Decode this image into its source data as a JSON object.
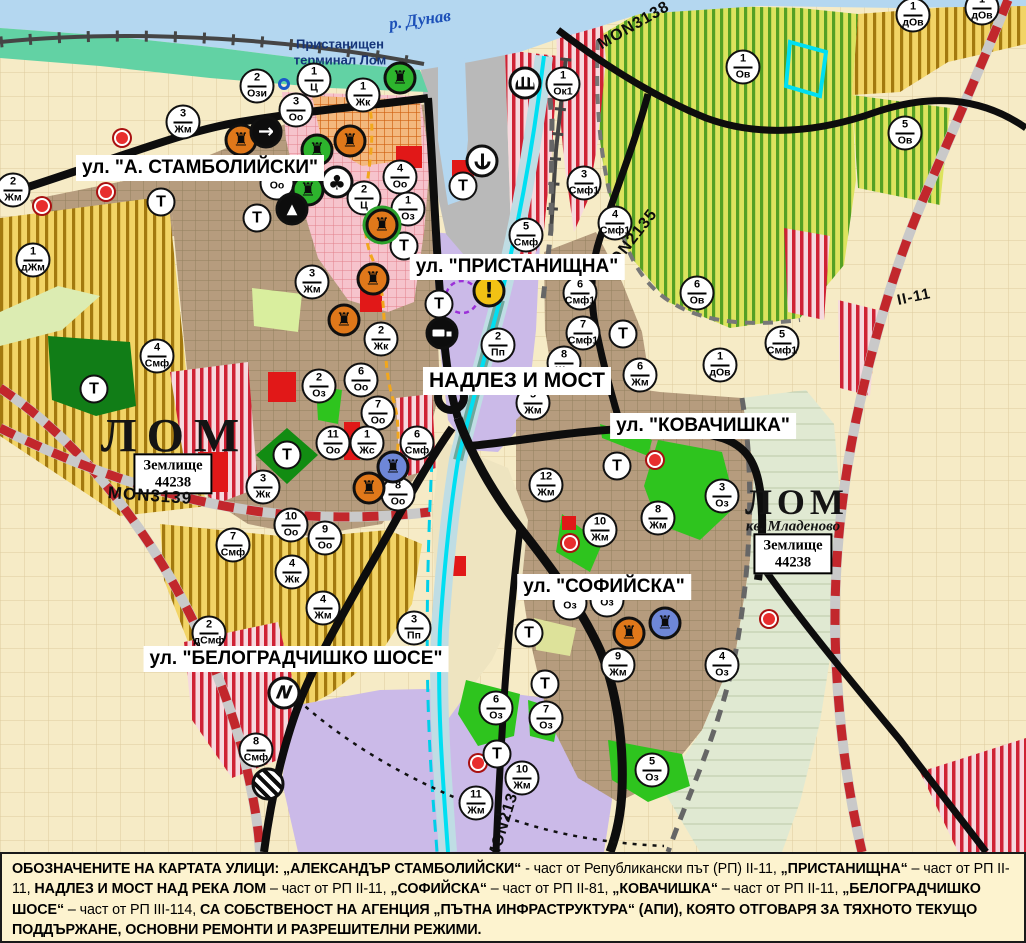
{
  "map": {
    "river_label": "р. Дунав",
    "port_label": "Пристанищен\nтерминал Лом",
    "t_label": "Т",
    "area_labels": {
      "lom_left": "ЛОМ",
      "lom_right": "ЛОМ",
      "lom_right_sub": "кв. Младеново",
      "registry_box_left": "Землище\n44238",
      "registry_box_right": "Землище\n44238"
    },
    "street_labels": [
      {
        "text": "ул. \"А. СТАМБОЛИЙСКИ\"",
        "x": 200,
        "y": 168,
        "fs": 19
      },
      {
        "text": "ул. \"ПРИСТАНИЩНА\"",
        "x": 517,
        "y": 267,
        "fs": 19
      },
      {
        "text": "НАДЛЕЗ И МОСТ",
        "x": 517,
        "y": 381,
        "fs": 21
      },
      {
        "text": "ул. \"КОВАЧИШКА\"",
        "x": 703,
        "y": 426,
        "fs": 19
      },
      {
        "text": "ул. \"СОФИЙСКА\"",
        "x": 604,
        "y": 587,
        "fs": 19
      },
      {
        "text": "ул. \"БЕЛОГРАДЧИШКО ШОСЕ\"",
        "x": 296,
        "y": 659,
        "fs": 19
      }
    ],
    "road_labels": [
      {
        "text": "MON3138",
        "x": 634,
        "y": 26,
        "rot": -30,
        "fs": 16
      },
      {
        "text": "MON2135",
        "x": 630,
        "y": 243,
        "rot": -52,
        "fs": 16
      },
      {
        "text": "MON3139",
        "x": 150,
        "y": 496,
        "rot": 4,
        "fs": 17
      },
      {
        "text": "MON2136",
        "x": 505,
        "y": 822,
        "rot": -73,
        "fs": 16
      },
      {
        "text": "II-11",
        "x": 914,
        "y": 297,
        "rot": -12,
        "fs": 15
      }
    ],
    "zone_markers": [
      {
        "n": "2",
        "c": "Ози",
        "x": 257,
        "y": 86
      },
      {
        "n": "1",
        "c": "Ц",
        "x": 314,
        "y": 80
      },
      {
        "n": "1",
        "c": "Жк",
        "x": 363,
        "y": 95
      },
      {
        "n": "3",
        "c": "Оо",
        "x": 296,
        "y": 110
      },
      {
        "n": "3",
        "c": "Жм",
        "x": 183,
        "y": 122
      },
      {
        "n": "2",
        "c": "Жм",
        "x": 13,
        "y": 190
      },
      {
        "n": "1",
        "c": "дЖм",
        "x": 33,
        "y": 260
      },
      {
        "n": "",
        "c": "Оо",
        "x": 277,
        "y": 183
      },
      {
        "n": "4",
        "c": "Оо",
        "x": 400,
        "y": 177
      },
      {
        "n": "2",
        "c": "Ц",
        "x": 364,
        "y": 198
      },
      {
        "n": "1",
        "c": "Оз",
        "x": 408,
        "y": 209
      },
      {
        "n": "3",
        "c": "Жм",
        "x": 312,
        "y": 282
      },
      {
        "n": "1",
        "c": "Ок1",
        "x": 563,
        "y": 84
      },
      {
        "n": "3",
        "c": "Смф1",
        "x": 584,
        "y": 183
      },
      {
        "n": "5",
        "c": "Смф",
        "x": 526,
        "y": 235
      },
      {
        "n": "4",
        "c": "Смф1",
        "x": 615,
        "y": 223
      },
      {
        "n": "1",
        "c": "Ов",
        "x": 743,
        "y": 67
      },
      {
        "n": "1",
        "c": "дОв",
        "x": 913,
        "y": 15
      },
      {
        "n": "1",
        "c": "дОв",
        "x": 982,
        "y": 8
      },
      {
        "n": "5",
        "c": "Ов",
        "x": 905,
        "y": 133
      },
      {
        "n": "6",
        "c": "Ов",
        "x": 697,
        "y": 293
      },
      {
        "n": "1",
        "c": "дОв",
        "x": 720,
        "y": 365
      },
      {
        "n": "5",
        "c": "Смф1",
        "x": 782,
        "y": 343
      },
      {
        "n": "6",
        "c": "Смф1",
        "x": 580,
        "y": 293
      },
      {
        "n": "7",
        "c": "Смф1",
        "x": 583,
        "y": 333
      },
      {
        "n": "2",
        "c": "Пп",
        "x": 498,
        "y": 345
      },
      {
        "n": "8",
        "c": "Жм",
        "x": 564,
        "y": 363
      },
      {
        "n": "5",
        "c": "Жм",
        "x": 533,
        "y": 403
      },
      {
        "n": "6",
        "c": "Жм",
        "x": 640,
        "y": 375
      },
      {
        "n": "2",
        "c": "Жк",
        "x": 381,
        "y": 339
      },
      {
        "n": "6",
        "c": "Оо",
        "x": 361,
        "y": 380
      },
      {
        "n": "2",
        "c": "Оз",
        "x": 319,
        "y": 386
      },
      {
        "n": "7",
        "c": "Оо",
        "x": 378,
        "y": 413
      },
      {
        "n": "11",
        "c": "Оо",
        "x": 333,
        "y": 443
      },
      {
        "n": "1",
        "c": "Жс",
        "x": 367,
        "y": 443
      },
      {
        "n": "6",
        "c": "Смф",
        "x": 417,
        "y": 443
      },
      {
        "n": "8",
        "c": "Оо",
        "x": 398,
        "y": 494
      },
      {
        "n": "3",
        "c": "Жк",
        "x": 263,
        "y": 487
      },
      {
        "n": "10",
        "c": "Оо",
        "x": 291,
        "y": 525
      },
      {
        "n": "9",
        "c": "Оо",
        "x": 325,
        "y": 538
      },
      {
        "n": "7",
        "c": "Смф",
        "x": 233,
        "y": 545
      },
      {
        "n": "4",
        "c": "Смф",
        "x": 157,
        "y": 356
      },
      {
        "n": "4",
        "c": "Жк",
        "x": 292,
        "y": 572
      },
      {
        "n": "4",
        "c": "Жм",
        "x": 323,
        "y": 608
      },
      {
        "n": "2",
        "c": "дСмф",
        "x": 209,
        "y": 633
      },
      {
        "n": "3",
        "c": "Пп",
        "x": 414,
        "y": 628
      },
      {
        "n": "8",
        "c": "Смф",
        "x": 256,
        "y": 750
      },
      {
        "n": "12",
        "c": "Жм",
        "x": 546,
        "y": 485
      },
      {
        "n": "10",
        "c": "Жм",
        "x": 600,
        "y": 530
      },
      {
        "n": "8",
        "c": "Жм",
        "x": 658,
        "y": 518
      },
      {
        "n": "3",
        "c": "Оз",
        "x": 722,
        "y": 496
      },
      {
        "n": "9",
        "c": "Жм",
        "x": 618,
        "y": 665
      },
      {
        "n": "4",
        "c": "Оз",
        "x": 722,
        "y": 665
      },
      {
        "n": "",
        "c": "Оз",
        "x": 570,
        "y": 603
      },
      {
        "n": "",
        "c": "Оз",
        "x": 607,
        "y": 600
      },
      {
        "n": "6",
        "c": "Оз",
        "x": 496,
        "y": 708
      },
      {
        "n": "7",
        "c": "Оз",
        "x": 546,
        "y": 718
      },
      {
        "n": "10",
        "c": "Жм",
        "x": 522,
        "y": 778
      },
      {
        "n": "11",
        "c": "Жм",
        "x": 476,
        "y": 803
      },
      {
        "n": "5",
        "c": "Оз",
        "x": 652,
        "y": 770
      }
    ],
    "t_markers": [
      {
        "x": 161,
        "y": 202
      },
      {
        "x": 257,
        "y": 218
      },
      {
        "x": 404,
        "y": 246
      },
      {
        "x": 439,
        "y": 304
      },
      {
        "x": 463,
        "y": 186
      },
      {
        "x": 94,
        "y": 389
      },
      {
        "x": 287,
        "y": 455
      },
      {
        "x": 623,
        "y": 334
      },
      {
        "x": 617,
        "y": 466
      },
      {
        "x": 529,
        "y": 633
      },
      {
        "x": 545,
        "y": 684
      },
      {
        "x": 497,
        "y": 754
      }
    ],
    "icon_markers": [
      {
        "type": "monument-orange",
        "x": 241,
        "y": 140
      },
      {
        "type": "monument-orange",
        "x": 350,
        "y": 141
      },
      {
        "type": "monument-orange-green-ring",
        "x": 382,
        "y": 225
      },
      {
        "type": "monument-orange",
        "x": 373,
        "y": 279
      },
      {
        "type": "monument-orange",
        "x": 344,
        "y": 320
      },
      {
        "type": "monument-orange",
        "x": 369,
        "y": 488
      },
      {
        "type": "monument-orange",
        "x": 629,
        "y": 633
      },
      {
        "type": "monument-green",
        "x": 400,
        "y": 78
      },
      {
        "type": "monument-green",
        "x": 317,
        "y": 150
      },
      {
        "type": "monument-green",
        "x": 308,
        "y": 190
      },
      {
        "type": "monument-blue",
        "x": 393,
        "y": 467
      },
      {
        "type": "monument-blue",
        "x": 665,
        "y": 623
      },
      {
        "type": "arrow",
        "x": 266,
        "y": 132
      },
      {
        "type": "club",
        "x": 337,
        "y": 182
      },
      {
        "type": "mountain",
        "x": 292,
        "y": 209
      },
      {
        "type": "anchor",
        "x": 482,
        "y": 161
      },
      {
        "type": "fan",
        "x": 525,
        "y": 83
      },
      {
        "type": "truck",
        "x": 442,
        "y": 333
      },
      {
        "type": "warning",
        "x": 489,
        "y": 291
      },
      {
        "type": "lightning",
        "x": 284,
        "y": 693
      },
      {
        "type": "hatch",
        "x": 268,
        "y": 784
      }
    ],
    "red_dots": [
      {
        "x": 122,
        "y": 138
      },
      {
        "x": 106,
        "y": 192
      },
      {
        "x": 42,
        "y": 206
      },
      {
        "x": 655,
        "y": 460
      },
      {
        "x": 570,
        "y": 543
      },
      {
        "x": 769,
        "y": 619
      },
      {
        "x": 478,
        "y": 763
      }
    ],
    "blue_rings": [
      {
        "x": 284,
        "y": 84
      }
    ]
  },
  "caption": {
    "segments": [
      {
        "t": "ОБОЗНАЧЕНИТЕ НА КАРТАТА УЛИЦИ: „АЛЕКСАНДЪР СТАМБОЛИЙСКИ“",
        "b": 1
      },
      {
        "t": " - част от Републикански път (РП) II-11, ",
        "b": 0
      },
      {
        "t": "„ПРИСТАНИЩНА“",
        "b": 1
      },
      {
        "t": " – част от РП II-11, ",
        "b": 0
      },
      {
        "t": "НАДЛЕЗ И МОСТ НАД РЕКА ЛОМ",
        "b": 1
      },
      {
        "t": " – част от РП II-11, ",
        "b": 0
      },
      {
        "t": "„СОФИЙСКА“",
        "b": 1
      },
      {
        "t": " – част от РП II-81, ",
        "b": 0
      },
      {
        "t": "„КОВАЧИШКА“",
        "b": 1
      },
      {
        "t": " – част от РП II-11, ",
        "b": 0
      },
      {
        "t": "„БЕЛОГРАДЧИШКО ШОСЕ“",
        "b": 1
      },
      {
        "t": " – част от РП III-114, ",
        "b": 0
      },
      {
        "t": "СА СОБСТВЕНОСТ НА АГЕНЦИЯ „ПЪТНА ИНФРАСТРУКТУРА“ (АПИ), КОЯТО ОТГОВАРЯ ЗА ТЯХНОТО ТЕКУЩО ПОДДЪРЖАНЕ, ОСНОВНИ РЕМОНТИ И РАЗРЕШИТЕЛНИ РЕЖИМИ.",
        "b": 1
      }
    ]
  }
}
